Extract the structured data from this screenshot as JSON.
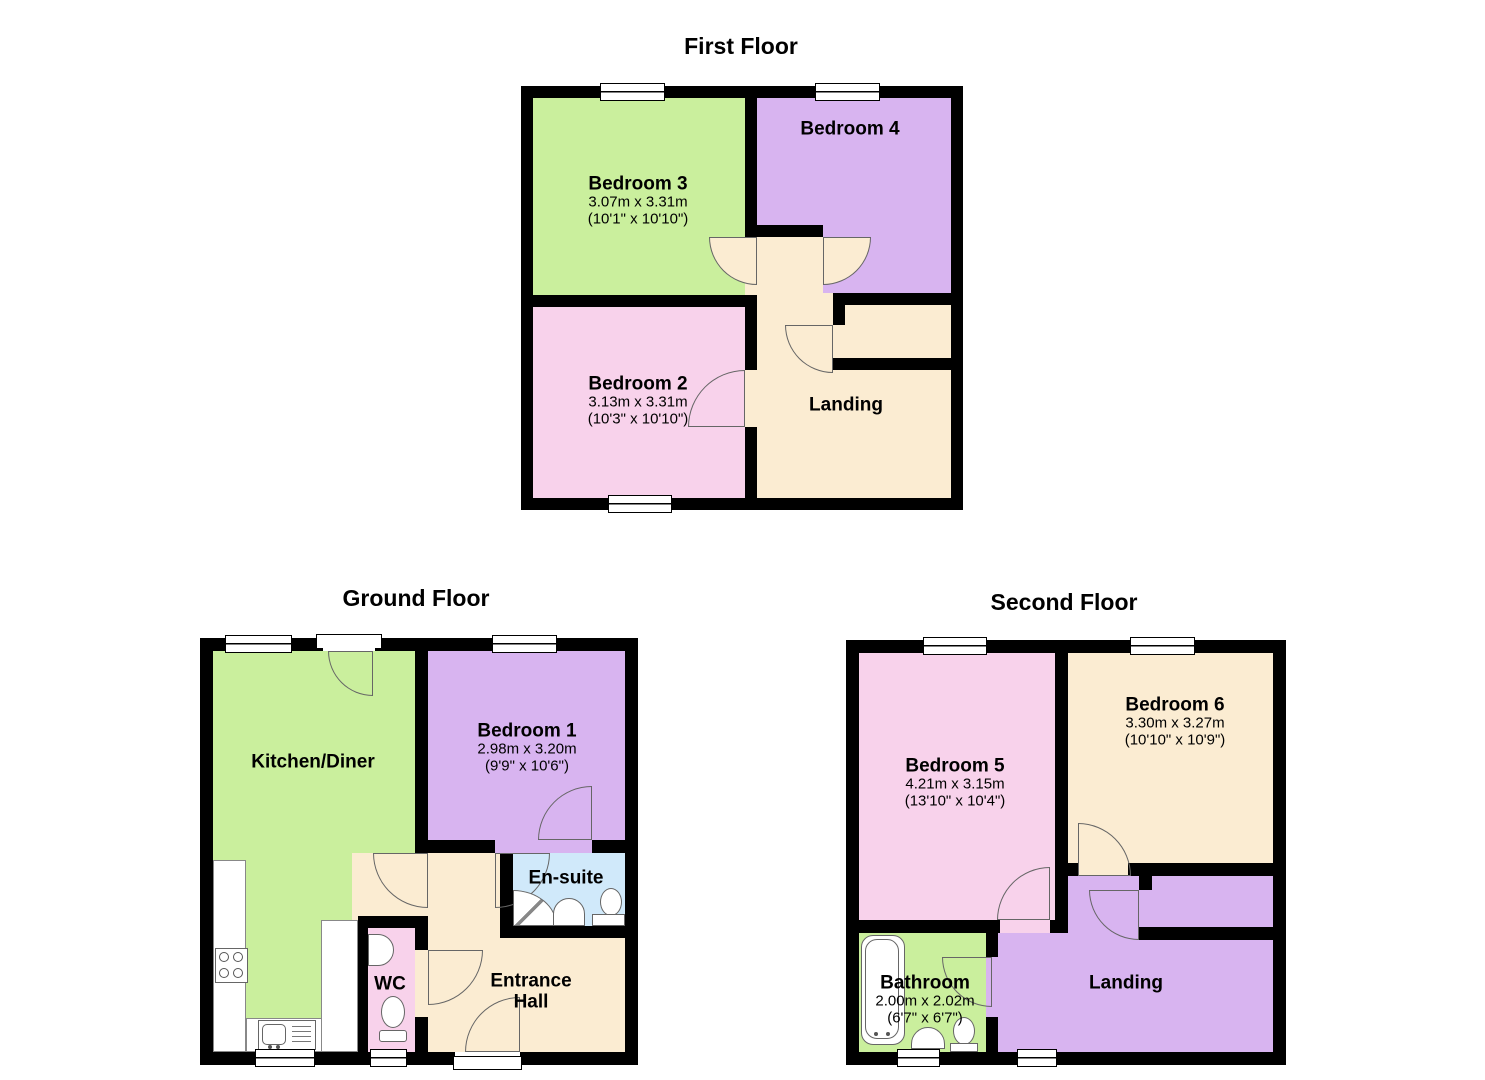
{
  "colors": {
    "wall": "#000000",
    "room_green": "#caef9d",
    "room_purple": "#d8b4f0",
    "room_pink": "#f8d2eb",
    "room_cream": "#fbecd2",
    "ensuite_blue": "#d0e9fa",
    "fixture_outline": "#666666",
    "text": "#000000"
  },
  "floors": {
    "first": {
      "title": "First Floor",
      "rooms": {
        "bedroom3": {
          "name": "Bedroom 3",
          "dims_m": "3.07m x 3.31m",
          "dims_ft": "(10'1\" x 10'10\")"
        },
        "bedroom4": {
          "name": "Bedroom 4"
        },
        "bedroom2": {
          "name": "Bedroom 2",
          "dims_m": "3.13m x 3.31m",
          "dims_ft": "(10'3\" x 10'10\")"
        },
        "landing": {
          "name": "Landing"
        }
      }
    },
    "ground": {
      "title": "Ground Floor",
      "rooms": {
        "kitchen": {
          "name": "Kitchen/Diner"
        },
        "bedroom1": {
          "name": "Bedroom 1",
          "dims_m": "2.98m x 3.20m",
          "dims_ft": "(9'9\" x 10'6\")"
        },
        "ensuite": {
          "name": "En-suite"
        },
        "wc": {
          "name": "WC"
        },
        "hall": {
          "name": "Entrance Hall",
          "line1": "Entrance",
          "line2": "Hall"
        }
      }
    },
    "second": {
      "title": "Second Floor",
      "rooms": {
        "bedroom5": {
          "name": "Bedroom 5",
          "dims_m": "4.21m x 3.15m",
          "dims_ft": "(13'10\" x 10'4\")"
        },
        "bedroom6": {
          "name": "Bedroom 6",
          "dims_m": "3.30m x 3.27m",
          "dims_ft": "(10'10\" x 10'9\")"
        },
        "bathroom": {
          "name": "Bathroom",
          "dims_m": "2.00m x 2.02m",
          "dims_ft": "(6'7\" x 6'7\")"
        },
        "landing": {
          "name": "Landing"
        }
      }
    }
  }
}
